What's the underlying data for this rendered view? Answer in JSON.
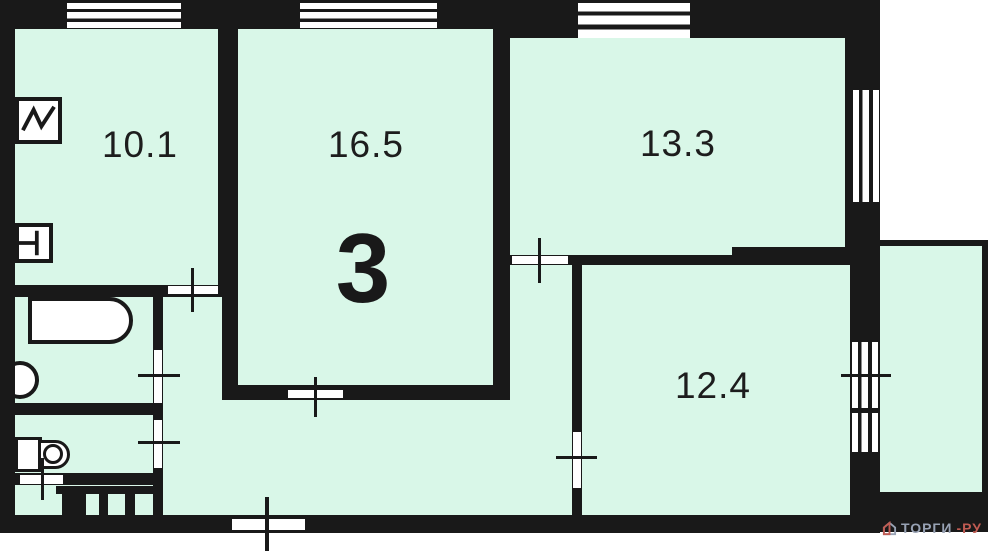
{
  "plan": {
    "apartment_rooms_count": "3",
    "rooms": [
      {
        "id": "kitchen",
        "area": "10.1"
      },
      {
        "id": "living",
        "area": "16.5"
      },
      {
        "id": "bedroom-1",
        "area": "13.3"
      },
      {
        "id": "bedroom-2",
        "area": "12.4"
      }
    ],
    "fixtures": [
      "kitchen-sink-icon",
      "stove-icon",
      "bathtub-icon",
      "wash-basin-icon",
      "toilet-icon"
    ],
    "colors": {
      "wall": "#191919",
      "floor": "#d9f7e8",
      "fixture_fill": "#ffffff",
      "watermark_gray": "#98a2b4",
      "watermark_red": "#c05b52"
    }
  },
  "watermark": {
    "part1": "ТОРГИ",
    "part2": "-РУ"
  }
}
